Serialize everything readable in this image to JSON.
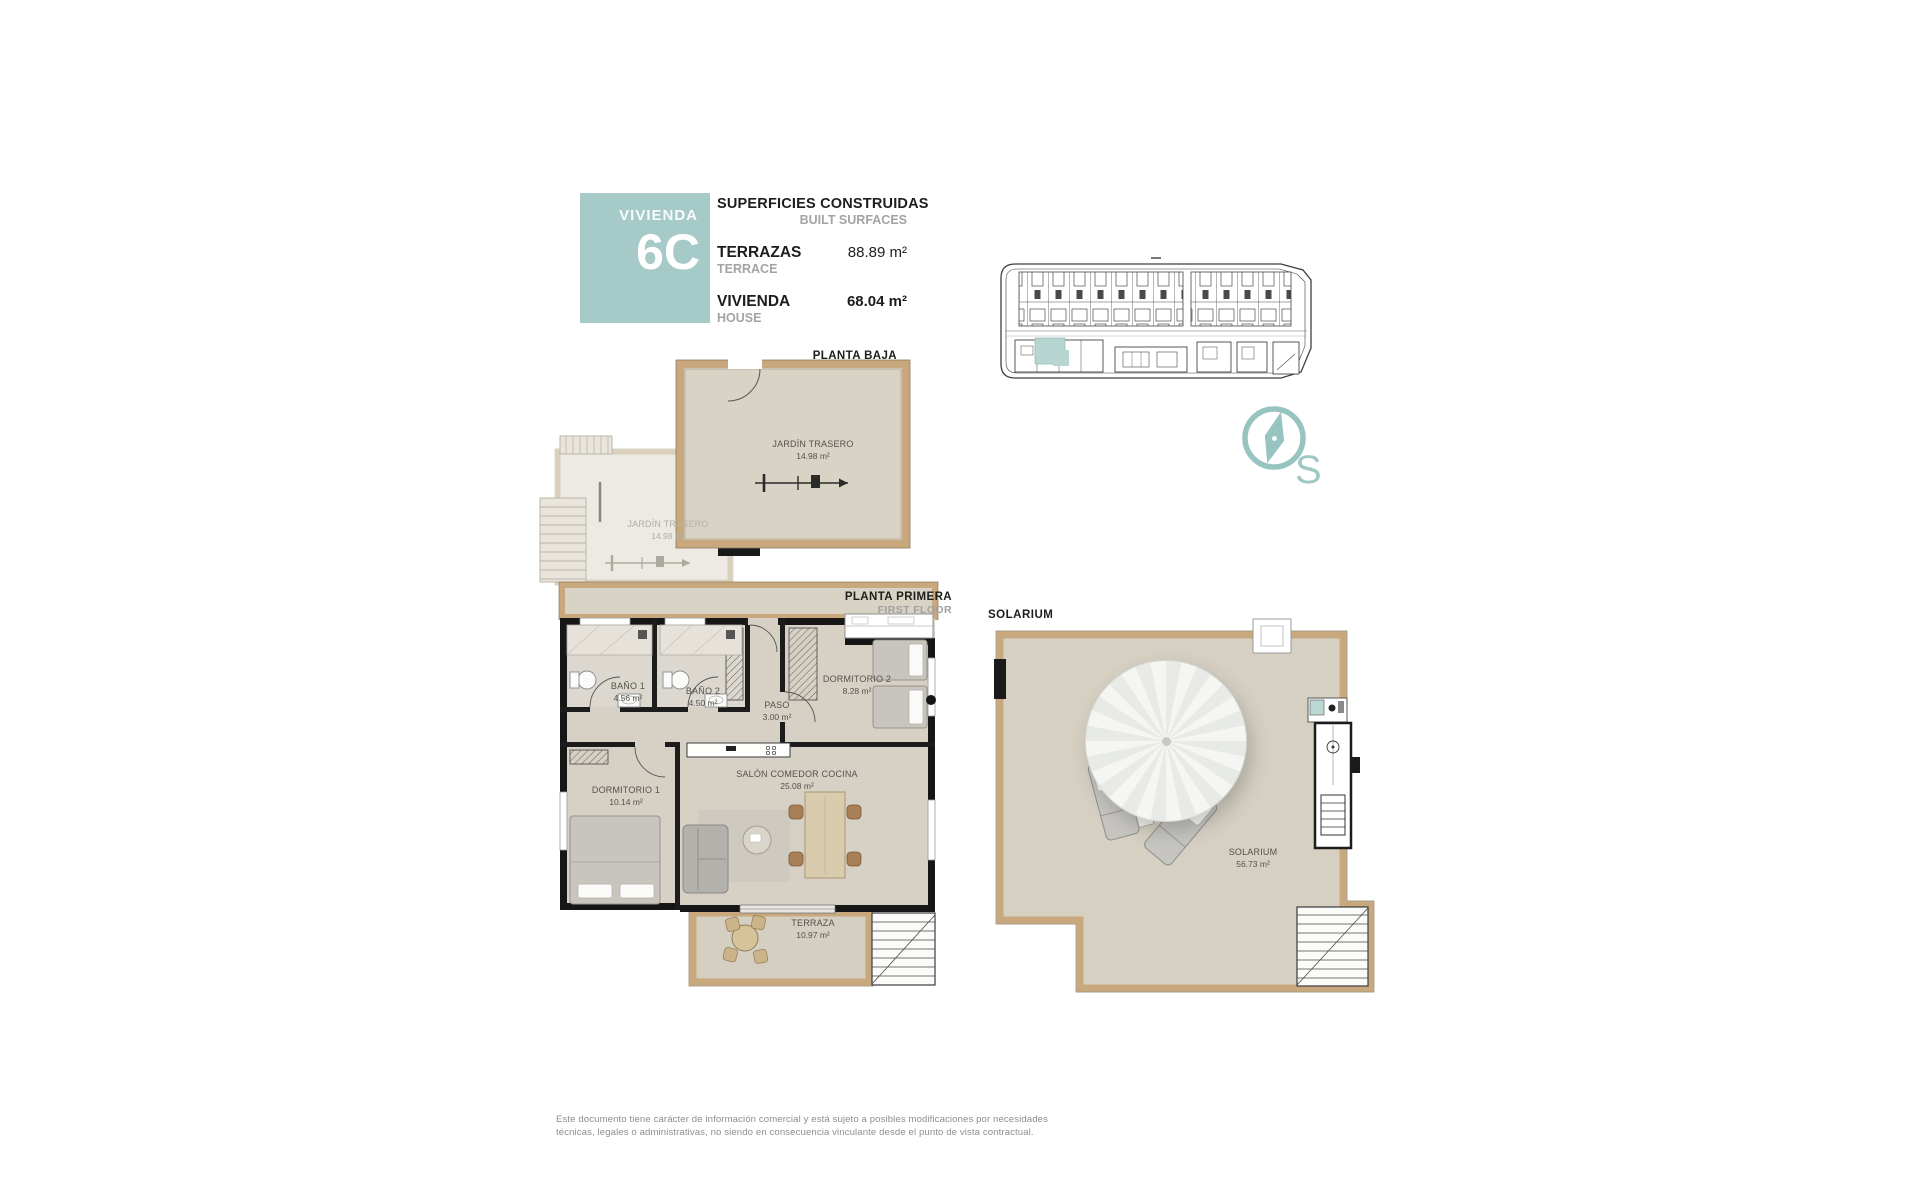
{
  "colors": {
    "accent": "#a6cac7",
    "highlight": "#b7d6d2",
    "wall_tan": "#c9a87e",
    "text_gray": "#a3a3a1"
  },
  "title_block": {
    "unit_label": "VIVIENDA",
    "unit_number": "6C",
    "heading_es": "SUPERFICIES CONSTRUIDAS",
    "heading_en": "BUILT SURFACES",
    "rows": [
      {
        "label_es": "TERRAZAS",
        "label_en": "TERRACE",
        "value": "88.89 m²"
      },
      {
        "label_es": "VIVIENDA",
        "label_en": "HOUSE",
        "value": "68.04 m²"
      }
    ]
  },
  "compass": {
    "south_label": "S"
  },
  "ground_floor": {
    "title_es": "PLANTA BAJA",
    "title_en": "GROUND FLOOR",
    "rooms": [
      {
        "name": "JARDÍN TRASERO",
        "area": "14.98 m²"
      },
      {
        "name": "JARDÍN TRASERO",
        "area": "14.98 m²"
      }
    ]
  },
  "first_floor": {
    "title_es": "PLANTA PRIMERA",
    "title_en": "FIRST FLOOR",
    "rooms": [
      {
        "name": "BAÑO 1",
        "area": "4.56 m²"
      },
      {
        "name": "BAÑO 2",
        "area": "4.50 m²"
      },
      {
        "name": "PASO",
        "area": "3.00 m²"
      },
      {
        "name": "DORMITORIO 2",
        "area": "8.28 m²"
      },
      {
        "name": "DORMITORIO 1",
        "area": "10.14 m²"
      },
      {
        "name": "SALÓN COMEDOR COCINA",
        "area": "25.08 m²"
      },
      {
        "name": "TERRAZA",
        "area": "10.97 m²"
      }
    ]
  },
  "solarium": {
    "title": "SOLARIUM",
    "room": {
      "name": "SOLARIUM",
      "area": "56.73 m²"
    }
  },
  "footer": {
    "line1": "Este documento tiene carácter de información comercial y está sujeto a posibles modificaciones por necesidades",
    "line2": "técnicas, legales o administrativas, no siendo en consecuencia vinculante desde el punto de vista contractual."
  }
}
